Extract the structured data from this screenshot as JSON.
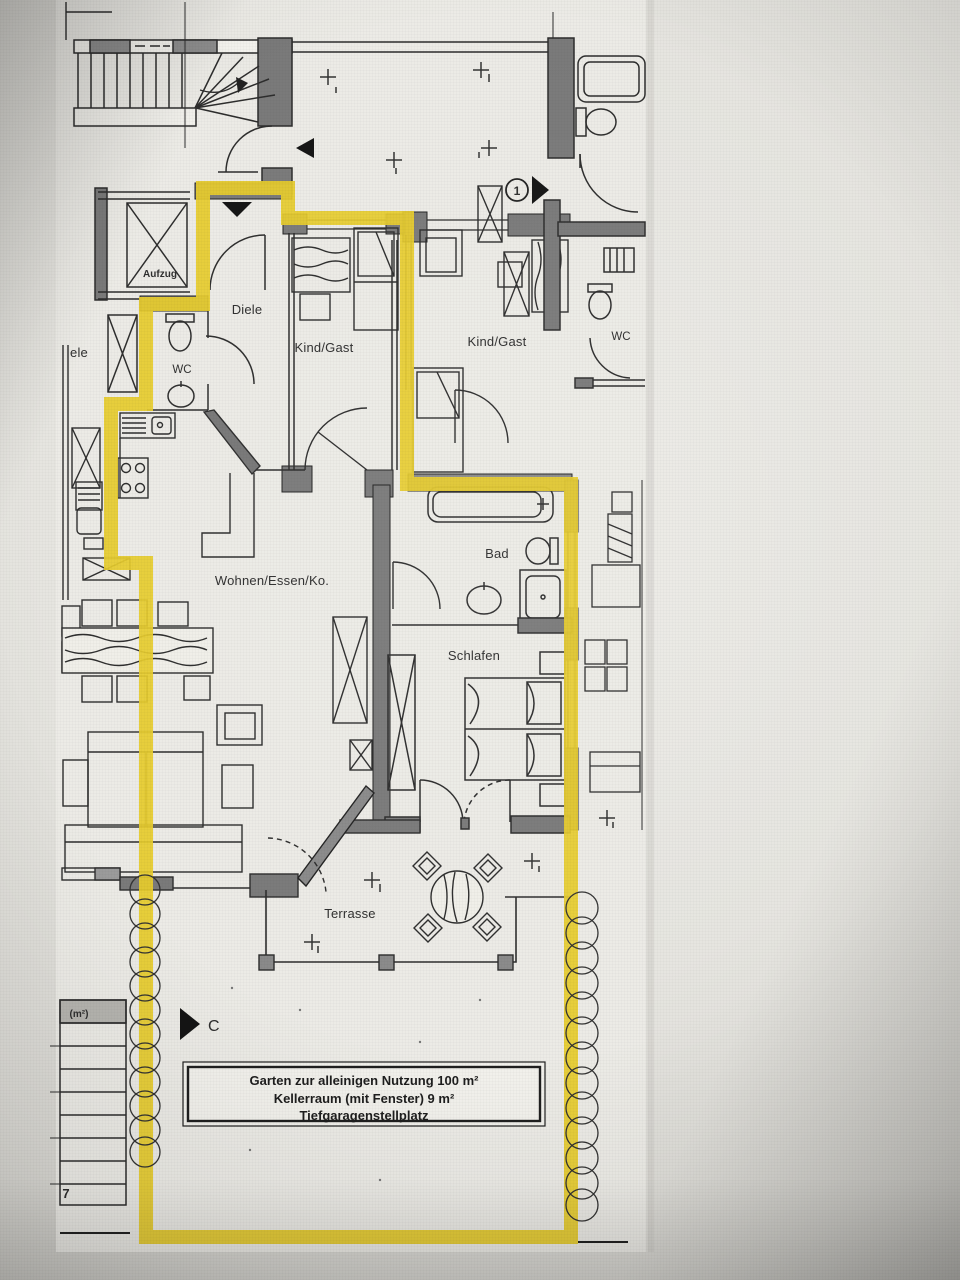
{
  "floor_plan": {
    "rooms": [
      {
        "id": "aufzug",
        "label": "Aufzug"
      },
      {
        "id": "diele",
        "label": "Diele"
      },
      {
        "id": "diele-neighbor-partial",
        "label": "ele"
      },
      {
        "id": "wc",
        "label": "WC"
      },
      {
        "id": "kind-gast-left",
        "label": "Kind/Gast"
      },
      {
        "id": "kind-gast-right",
        "label": "Kind/Gast"
      },
      {
        "id": "wc-neighbor",
        "label": "WC"
      },
      {
        "id": "bad",
        "label": "Bad"
      },
      {
        "id": "schlafen",
        "label": "Schlafen"
      },
      {
        "id": "wohnen-essen-kochen",
        "label": "Wohnen/Essen/Ko."
      },
      {
        "id": "terrasse",
        "label": "Terrasse"
      }
    ],
    "annotation_box": {
      "lines": [
        "Garten zur alleinigen Nutzung 100 m²",
        "Kellerraum (mit Fenster) 9 m²",
        "Tiefgaragenstellplatz"
      ]
    },
    "markers": {
      "area_unit": "(m²)",
      "parking_row_number": "7",
      "section_letter": "C",
      "entrance_number": "1"
    },
    "colors": {
      "highlight_boundary": "#e6cb2c",
      "walls": "#7a7a7a",
      "linework": "#2d2d2d",
      "paper": "#ebeae5"
    }
  }
}
